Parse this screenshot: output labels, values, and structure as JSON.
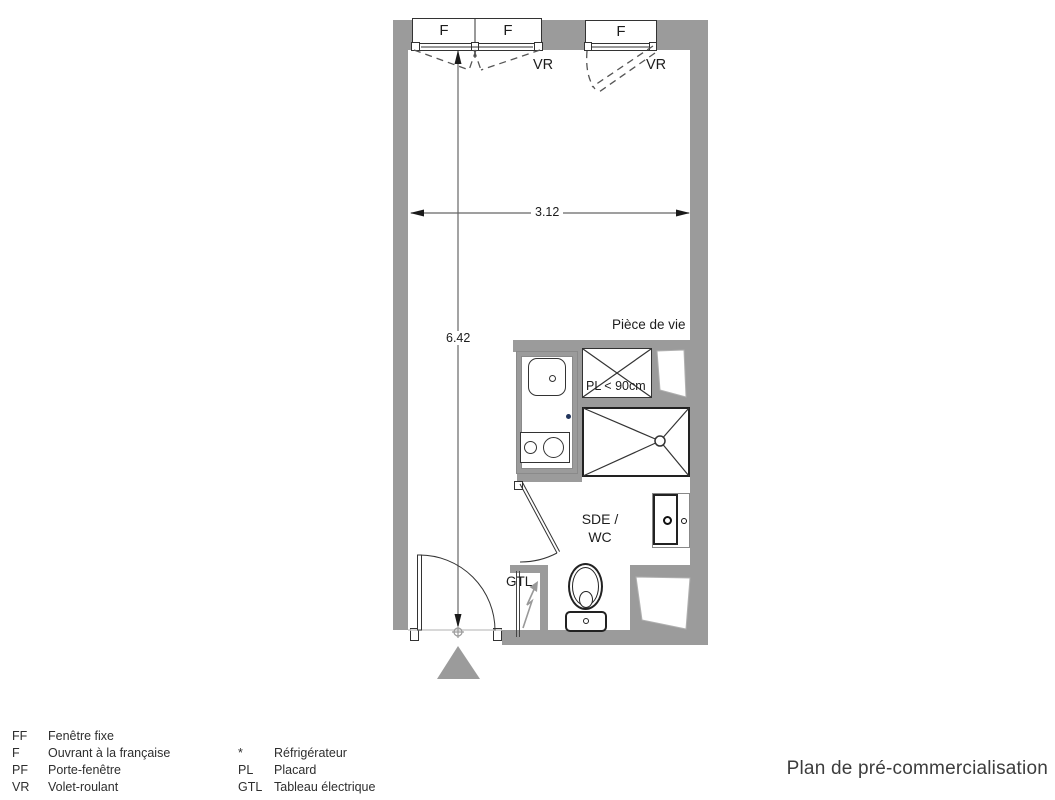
{
  "title": "Plan de pré-commercialisation",
  "plan": {
    "window_left": {
      "pane1": "F",
      "pane2": "F",
      "shutter": "VR"
    },
    "window_right": {
      "pane": "F",
      "shutter": "VR"
    },
    "dimensions": {
      "width_m": "3.12",
      "height_m": "6.42"
    },
    "labels": {
      "living_room": "Pièce de vie",
      "closet": "PL < 90cm",
      "bathroom_line1": "SDE /",
      "bathroom_line2": "WC",
      "electrical": "GTL"
    }
  },
  "legend": {
    "items_left": [
      {
        "abbr": "FF",
        "label": "Fenêtre fixe"
      },
      {
        "abbr": "F",
        "label": "Ouvrant à la française"
      },
      {
        "abbr": "PF",
        "label": "Porte-fenêtre"
      },
      {
        "abbr": "VR",
        "label": "Volet-roulant"
      }
    ],
    "items_right": [
      {
        "abbr": "*",
        "label": "Réfrigérateur"
      },
      {
        "abbr": "PL",
        "label": "Placard"
      },
      {
        "abbr": "GTL",
        "label": "Tableau électrique"
      }
    ]
  },
  "colors": {
    "wall": "#9b9b9b",
    "line": "#333333",
    "dash": "#555555",
    "dim": "#666666",
    "marker": "#23355c",
    "text": "#1d1d1d"
  }
}
